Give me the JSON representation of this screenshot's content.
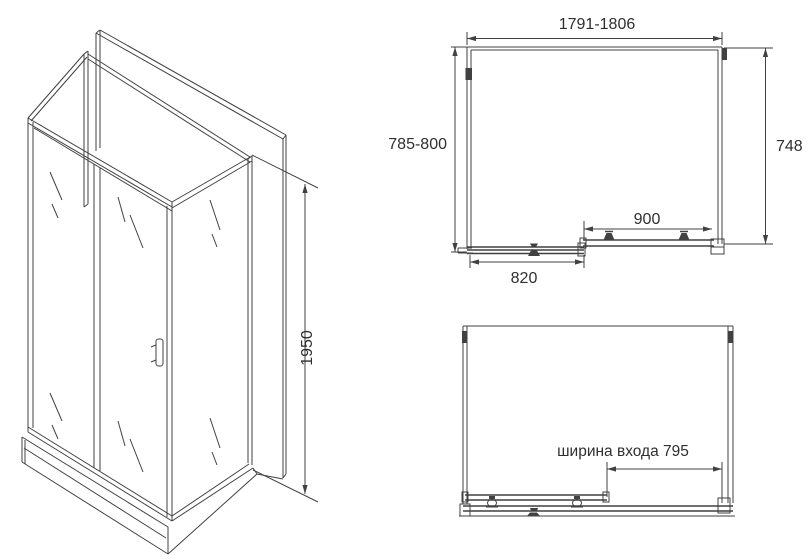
{
  "iso_view": {
    "height_dim": "1950"
  },
  "plan_view": {
    "width_dim": "1791-1806",
    "left_depth_dim": "785-800",
    "side_panel_dim": "748",
    "door_dim": "900",
    "fixed_panel_dim": "820"
  },
  "open_view": {
    "entrance_dim": "ширина входа 795"
  },
  "colors": {
    "line": "#414141",
    "text": "#2f2f2f",
    "background": "#ffffff"
  }
}
